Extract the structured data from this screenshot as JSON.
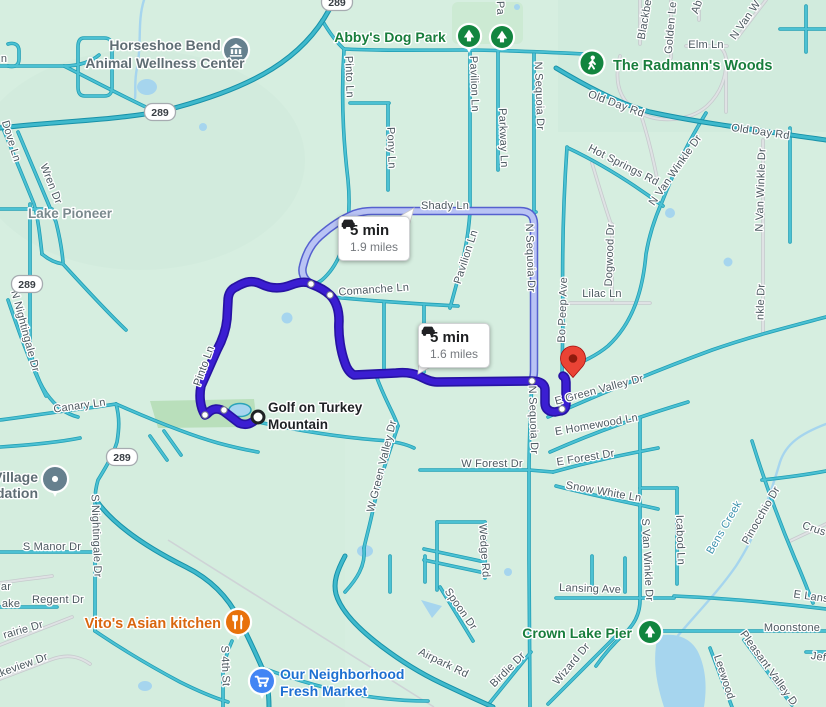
{
  "app": {
    "name": "map route view"
  },
  "routes": {
    "selected": {
      "duration": "5 min",
      "distance": "1.6 miles"
    },
    "alternate": {
      "duration": "5 min",
      "distance": "1.9 miles"
    }
  },
  "origin": {
    "label_lines": [
      "Golf on Turkey",
      "Mountain"
    ]
  },
  "colors": {
    "selected_route": "#3b1ed2",
    "alternate_route_fill": "#b9c3f4",
    "alternate_route_edge": "#5560cf",
    "road_fill": "#44bcce",
    "road_edge": "#1f9cb0",
    "water": "#a6d5ee",
    "background": "#d6eee0",
    "destination_pin": "#ea4335",
    "park_green": "#12853f",
    "restaurant_orange": "#e8710a",
    "store_blue": "#4285f4"
  },
  "highway_badges": [
    {
      "text": "289",
      "x": 160,
      "y": 112
    },
    {
      "text": "289",
      "x": 27,
      "y": 284
    },
    {
      "text": "289",
      "x": 122,
      "y": 457
    },
    {
      "text": "289",
      "x": 337,
      "y": 2
    }
  ],
  "streets": [
    {
      "t": "n",
      "x": 4,
      "y": 62,
      "r": 0
    },
    {
      "t": "Dove Ln",
      "x": 8,
      "y": 142,
      "r": 73
    },
    {
      "t": "Wren Dr",
      "x": 48,
      "y": 185,
      "r": 68
    },
    {
      "t": "N Nightingale Dr",
      "x": 22,
      "y": 332,
      "r": 75
    },
    {
      "t": "Canary Ln",
      "x": 80,
      "y": 409,
      "r": -8
    },
    {
      "t": "S Nightingale Dr",
      "x": 93,
      "y": 536,
      "r": 88
    },
    {
      "t": "S Manor Dr",
      "x": 52,
      "y": 550,
      "r": 0
    },
    {
      "t": "Regent Dr",
      "x": 58,
      "y": 603,
      "r": 0
    },
    {
      "t": "ar",
      "x": 6,
      "y": 590,
      "r": 0
    },
    {
      "t": "ake",
      "x": 11,
      "y": 607,
      "r": 0
    },
    {
      "t": "rairie Dr",
      "x": 24,
      "y": 633,
      "r": -16
    },
    {
      "t": "akeview Dr",
      "x": 22,
      "y": 669,
      "r": -20
    },
    {
      "t": "S 4th St",
      "x": 222,
      "y": 666,
      "r": 88
    },
    {
      "t": "Pinto Ln",
      "x": 346,
      "y": 77,
      "r": 88
    },
    {
      "t": "Pinto Ln",
      "x": 207,
      "y": 367,
      "r": -70
    },
    {
      "t": "Pony Ln",
      "x": 388,
      "y": 148,
      "r": 88
    },
    {
      "t": "Pavilion Ln",
      "x": 471,
      "y": 84,
      "r": 88
    },
    {
      "t": "Pavilion Ln",
      "x": 469,
      "y": 258,
      "r": -72
    },
    {
      "t": "Pa",
      "x": 497,
      "y": 8,
      "r": 88
    },
    {
      "t": "Parkway Ln",
      "x": 500,
      "y": 138,
      "r": 88
    },
    {
      "t": "N Sequoia Dr",
      "x": 536,
      "y": 96,
      "r": 88
    },
    {
      "t": "N Sequoia Dr",
      "x": 527,
      "y": 258,
      "r": 88
    },
    {
      "t": "N Sequoia Dr",
      "x": 530,
      "y": 420,
      "r": 88
    },
    {
      "t": "Shady Ln",
      "x": 445,
      "y": 209,
      "r": 0
    },
    {
      "t": "Comanche Ln",
      "x": 374,
      "y": 293,
      "r": -4
    },
    {
      "t": "Bo Peep Ave",
      "x": 566,
      "y": 310,
      "r": -88
    },
    {
      "t": "Lilac Ln",
      "x": 602,
      "y": 297,
      "r": 0
    },
    {
      "t": "Dogwood Dr",
      "x": 613,
      "y": 255,
      "r": -88
    },
    {
      "t": "Hot Springs Rd",
      "x": 622,
      "y": 168,
      "r": 27
    },
    {
      "t": "N Van Winkle Dr",
      "x": 678,
      "y": 172,
      "r": -55
    },
    {
      "t": "N Van Winkle Dr",
      "x": 764,
      "y": 190,
      "r": -88
    },
    {
      "t": "nkle Dr",
      "x": 764,
      "y": 302,
      "r": -88
    },
    {
      "t": "Old Day Rd",
      "x": 615,
      "y": 107,
      "r": 20
    },
    {
      "t": "Old Day Rd",
      "x": 760,
      "y": 135,
      "r": 8
    },
    {
      "t": "Elm Ln",
      "x": 706,
      "y": 48,
      "r": 0
    },
    {
      "t": "Blackbe",
      "x": 648,
      "y": 20,
      "r": -80
    },
    {
      "t": "Golden Le",
      "x": 674,
      "y": 28,
      "r": -85
    },
    {
      "t": "Ab",
      "x": 700,
      "y": 8,
      "r": -70
    },
    {
      "t": "N Van W",
      "x": 748,
      "y": 22,
      "r": -55
    },
    {
      "t": "E Green Valley Dr",
      "x": 600,
      "y": 393,
      "r": -15
    },
    {
      "t": "E Homewood Ln",
      "x": 597,
      "y": 428,
      "r": -10
    },
    {
      "t": "E Forest Dr",
      "x": 586,
      "y": 461,
      "r": -9
    },
    {
      "t": "W Forest Dr",
      "x": 492,
      "y": 467,
      "r": 0
    },
    {
      "t": "Snow White Ln",
      "x": 603,
      "y": 495,
      "r": 10
    },
    {
      "t": "W Green Valley Dr",
      "x": 385,
      "y": 467,
      "r": -76
    },
    {
      "t": "Wedge Rd",
      "x": 481,
      "y": 551,
      "r": 86
    },
    {
      "t": "Spoon Dr",
      "x": 458,
      "y": 611,
      "r": 55
    },
    {
      "t": "Airpark Rd",
      "x": 442,
      "y": 666,
      "r": 26
    },
    {
      "t": "Birdie Dr",
      "x": 510,
      "y": 672,
      "r": -45
    },
    {
      "t": "Wizard Dr",
      "x": 574,
      "y": 666,
      "r": -50
    },
    {
      "t": "Lansing Ave",
      "x": 590,
      "y": 592,
      "r": 2
    },
    {
      "t": "E Lansi",
      "x": 812,
      "y": 600,
      "r": 8
    },
    {
      "t": "Moonstone",
      "x": 792,
      "y": 631,
      "r": 0
    },
    {
      "t": "S Van Winkle Dr",
      "x": 644,
      "y": 560,
      "r": 87
    },
    {
      "t": "Icabod Ln",
      "x": 677,
      "y": 540,
      "r": 88
    },
    {
      "t": "Bens Creek",
      "x": 727,
      "y": 529,
      "r": -60,
      "cls": "water"
    },
    {
      "t": "Pinocchio Dr",
      "x": 764,
      "y": 517,
      "r": -60
    },
    {
      "t": "Crus",
      "x": 813,
      "y": 532,
      "r": 18
    },
    {
      "t": "Leewood",
      "x": 721,
      "y": 678,
      "r": 72
    },
    {
      "t": "Pleasant Valley D",
      "x": 766,
      "y": 670,
      "r": 54
    },
    {
      "t": "Jef",
      "x": 818,
      "y": 660,
      "r": 8
    }
  ],
  "pois": [
    {
      "name": "horseshoe-bend-animal-wellness-center",
      "lines": [
        "Horseshoe Bend",
        "Animal Wellness Center"
      ],
      "x": 165,
      "y": 50,
      "lh": 18,
      "anchor": "middle",
      "color": "#5f6d74",
      "size": 14,
      "icon": {
        "type": "bank",
        "x": 236,
        "y": 50,
        "bg": "#66808e",
        "tail": true,
        "r": 12
      }
    },
    {
      "name": "abbys-dog-park",
      "lines": [
        "Abby's Dog Park"
      ],
      "x": 390,
      "y": 42,
      "anchor": "middle",
      "color": "#187d3c",
      "size": 14,
      "icon": {
        "type": "tree",
        "x": 469,
        "y": 36,
        "bg": "#12853f",
        "tail": true,
        "r": 11
      }
    },
    {
      "name": "park",
      "lines": [],
      "x": 502,
      "y": 37,
      "anchor": "middle",
      "color": "#187d3c",
      "size": 14,
      "icon": {
        "type": "tree",
        "x": 502,
        "y": 37,
        "bg": "#12853f",
        "tail": false,
        "r": 11
      }
    },
    {
      "name": "the-radmanns-woods",
      "lines": [
        "The Radmann's Woods"
      ],
      "x": 613,
      "y": 70,
      "anchor": "start",
      "color": "#187d3c",
      "size": 14.5,
      "icon": {
        "type": "walk",
        "x": 592,
        "y": 63,
        "bg": "#12853f",
        "tail": false,
        "r": 11.5
      }
    },
    {
      "name": "lake-pioneer",
      "lines": [
        "Lake Pioneer"
      ],
      "x": 70,
      "y": 218,
      "anchor": "middle",
      "color": "#7b8a8e",
      "size": 13.5
    },
    {
      "name": "golf-on-turkey-mountain",
      "lines": [
        "Golf on Turkey",
        "Mountain"
      ],
      "x": 268,
      "y": 412,
      "lh": 17,
      "anchor": "start",
      "color": "#1f2125",
      "size": 13.5
    },
    {
      "name": "village-foundation",
      "lines": [
        "Village",
        "dation"
      ],
      "x": 38,
      "y": 482,
      "lh": 16,
      "anchor": "end",
      "color": "#5f6d74",
      "size": 14,
      "icon": {
        "type": "dot",
        "x": 55,
        "y": 479,
        "bg": "#66808e",
        "tail": true,
        "r": 12
      }
    },
    {
      "name": "vitos-asian-kitchen",
      "lines": [
        "Vito's Asian kitchen"
      ],
      "x": 221,
      "y": 628,
      "anchor": "end",
      "color": "#d9660f",
      "size": 14.5,
      "icon": {
        "type": "food",
        "x": 238,
        "y": 622,
        "bg": "#e8710a",
        "tail": true,
        "r": 12
      }
    },
    {
      "name": "our-neighborhood-fresh-market",
      "lines": [
        "Our Neighborhood",
        "Fresh Market"
      ],
      "x": 280,
      "y": 679,
      "lh": 17,
      "anchor": "start",
      "color": "#1d6fd1",
      "size": 14,
      "icon": {
        "type": "cart",
        "x": 262,
        "y": 681,
        "bg": "#4285f4",
        "tail": true,
        "r": 12
      }
    },
    {
      "name": "crown-lake-pier",
      "lines": [
        "Crown Lake Pier"
      ],
      "x": 632,
      "y": 638,
      "anchor": "end",
      "color": "#187d3c",
      "size": 14,
      "icon": {
        "type": "tree",
        "x": 650,
        "y": 632,
        "bg": "#12853f",
        "tail": false,
        "r": 11
      }
    }
  ]
}
